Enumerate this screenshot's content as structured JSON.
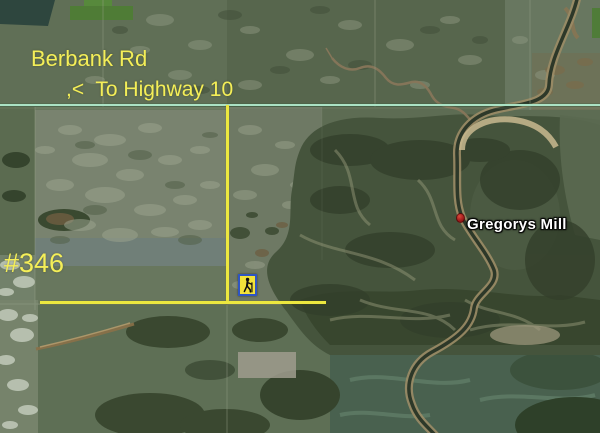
{
  "map": {
    "type": "satellite-aerial-view",
    "labels": {
      "road_name": "Berbank Rd",
      "highway_note": ",<  To Highway 10",
      "parcel_number": "#346",
      "poi_name": "Gregorys Mill"
    },
    "icons": [
      {
        "name": "hiker-waypoint-icon",
        "description": "yellow square with blue border containing black hiking figure"
      },
      {
        "name": "placemark-dot-icon",
        "description": "small red placemark dot left of Gregorys Mill label"
      }
    ],
    "overlays": {
      "road_overlay": "pale green horizontal road line across full width",
      "boundary_lines": "yellow vertical and horizontal property boundary lines meeting at a corner"
    },
    "colors": {
      "annotation_yellow_line": "#ece73f",
      "label_yellow": "#f4ee58",
      "road_overlay_green": "#abe2c4",
      "poi_label_white": "#ffffff",
      "placemark_red": "#a51d1d",
      "hiker_icon_fill": "#f2e23a",
      "hiker_icon_border": "#2f55c2"
    }
  }
}
